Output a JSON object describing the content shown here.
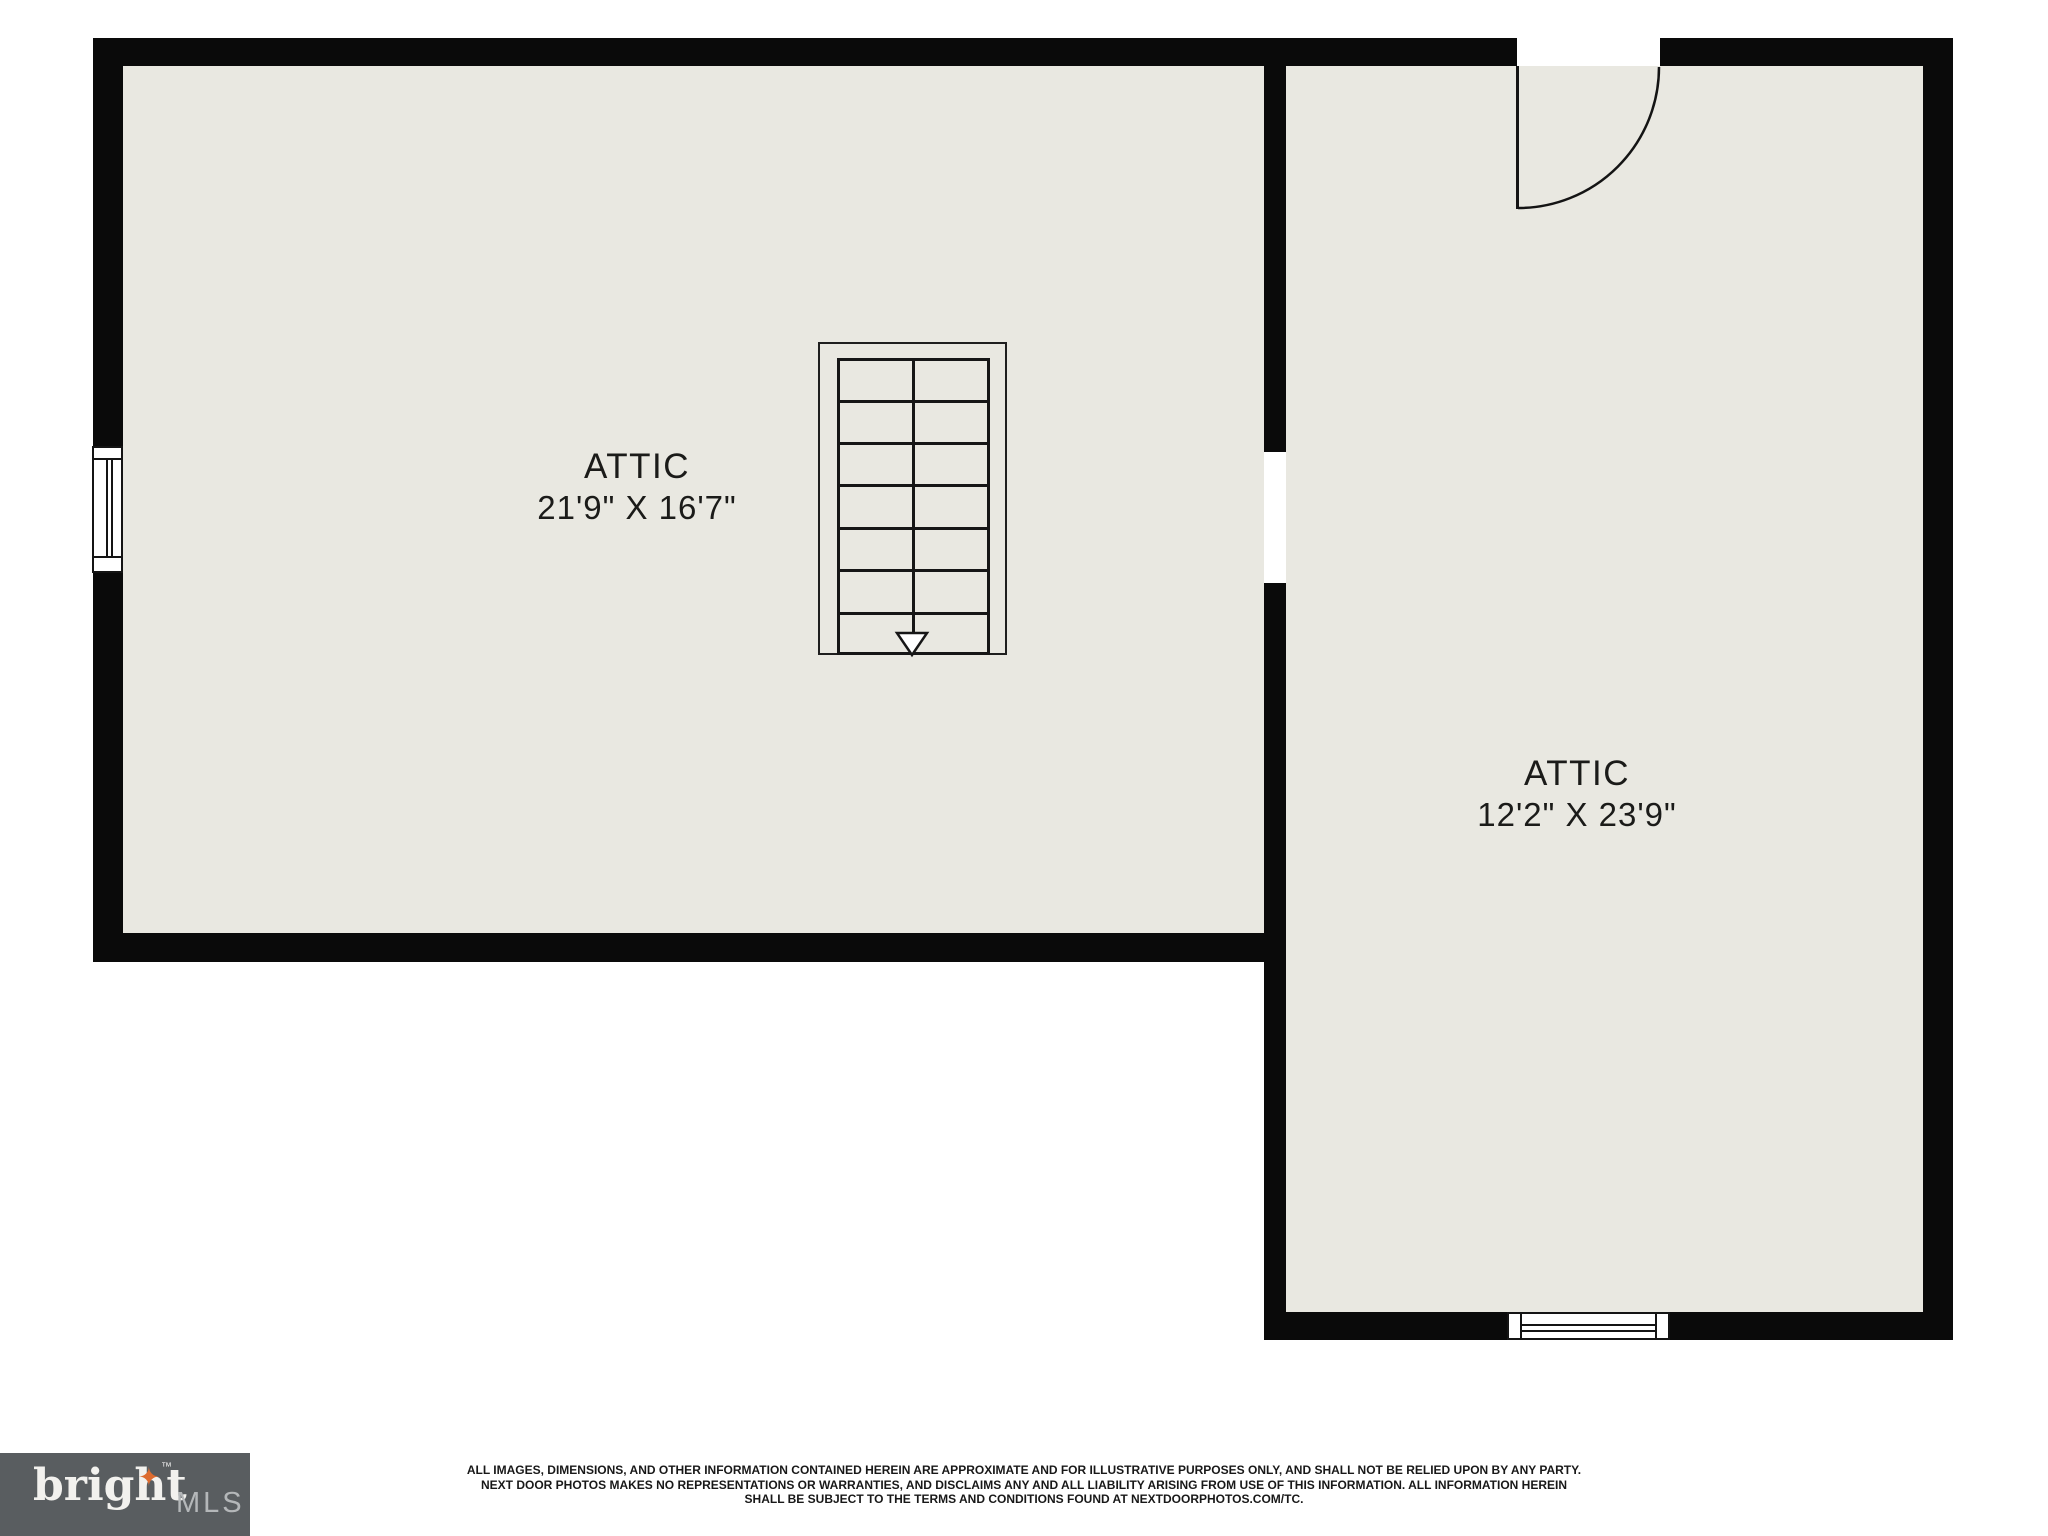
{
  "plan": {
    "rooms": [
      {
        "label": "ATTIC",
        "dimensions": "21'9\" X 16'7\""
      },
      {
        "label": "ATTIC",
        "dimensions": "12'2\" X 23'9\""
      }
    ]
  },
  "footer": {
    "logo": {
      "brand": "bright",
      "star": "✦",
      "trademark": "™",
      "suffix": "MLS"
    },
    "disclaimer": [
      "ALL IMAGES, DIMENSIONS, AND OTHER INFORMATION CONTAINED HEREIN ARE APPROXIMATE AND FOR ILLUSTRATIVE PURPOSES ONLY, AND SHALL NOT BE RELIED UPON BY ANY PARTY.",
      "NEXT DOOR PHOTOS MAKES NO REPRESENTATIONS OR WARRANTIES, AND DISCLAIMS ANY AND ALL LIABILITY ARISING FROM USE OF THIS INFORMATION. ALL INFORMATION HEREIN",
      "SHALL BE SUBJECT TO THE TERMS AND CONDITIONS FOUND AT NEXTDOORPHOTOS.COM/TC."
    ]
  },
  "colors": {
    "floor": "#e9e8e1",
    "wall": "#0a0a0a",
    "logo_background": "#595d60",
    "logo_star": "#dd6b2f",
    "logo_mls_text": "#b4b7b9"
  }
}
